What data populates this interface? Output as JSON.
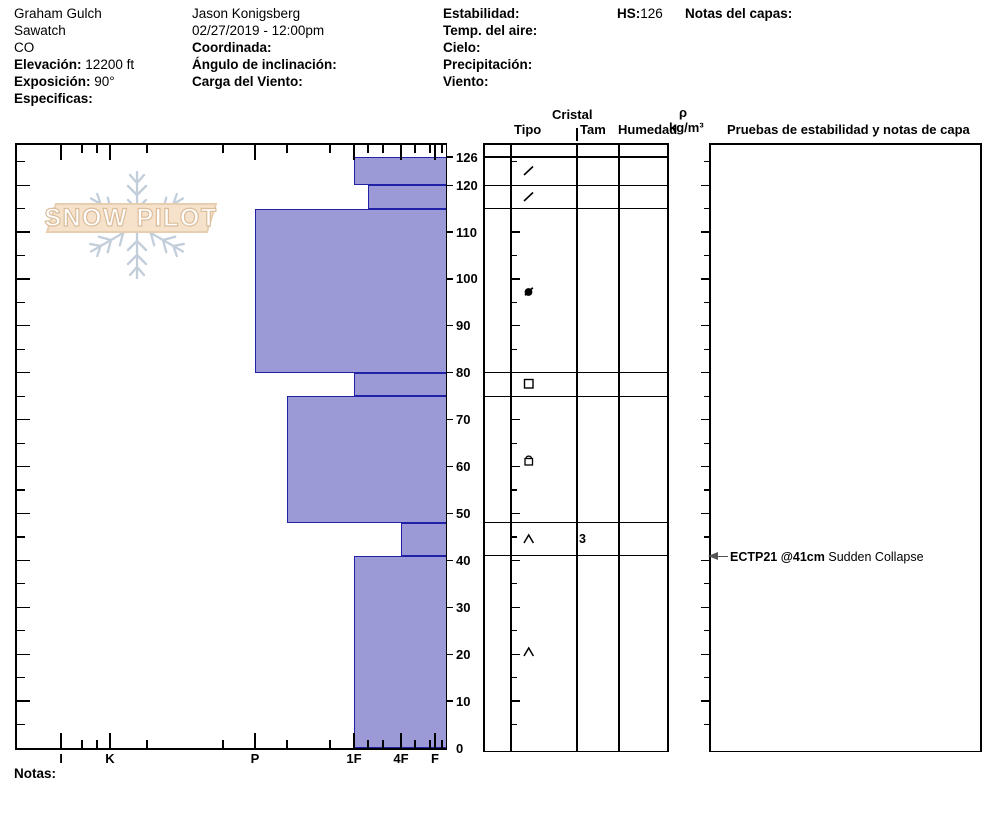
{
  "header": {
    "site": {
      "name": "Graham Gulch",
      "range": "Sawatch",
      "state": "CO",
      "elevation_label": "Elevación:",
      "elevation_value": "12200 ft",
      "aspect_label": "Exposición:",
      "aspect_value": "90°",
      "specifics_label": "Especificas:"
    },
    "observer": {
      "name": "Jason Konigsberg",
      "datetime": "02/27/2019 - 12:00pm",
      "coordinate_label": "Coordinada:",
      "slope_angle_label": "Ángulo de inclinación:",
      "wind_loading_label": "Carga del Viento:"
    },
    "weather": {
      "stability_label": "Estabilidad:",
      "air_temp_label": "Temp. del aire:",
      "sky_label": "Cielo:",
      "precipitation_label": "Precipitación:",
      "wind_label": "Viento:"
    },
    "hs_label": "HS:",
    "hs_value": "126",
    "layer_notes_label": "Notas del capas:"
  },
  "logo": {
    "text": "SNOW PILOT"
  },
  "chart_data": {
    "type": "bar",
    "orientation": "horizontal-hardness-profile",
    "depth_unit": "cm",
    "depth_max": 126,
    "snow_height": 126,
    "depth_labels": [
      126,
      120,
      110,
      100,
      90,
      80,
      70,
      60,
      50,
      40,
      30,
      20,
      10,
      0
    ],
    "hardness_categories": [
      {
        "label": "I",
        "x": 61
      },
      {
        "label": "K",
        "x": 110
      },
      {
        "label": "P",
        "x": 255
      },
      {
        "label": "1F",
        "x": 354
      },
      {
        "label": "4F",
        "x": 401
      },
      {
        "label": "F",
        "x": 435
      }
    ],
    "hardness_minor_ticks_x": [
      82,
      97,
      147,
      223,
      287,
      330,
      368,
      383,
      415,
      430,
      442
    ],
    "bar_fill": "#9b9ad7",
    "bar_border": "#2121a8",
    "layers": [
      {
        "top": 126,
        "bottom": 120,
        "hardness": "1F",
        "hardness_x": 354,
        "grain_type": "DF",
        "symbol": "slash",
        "size": "",
        "moisture": ""
      },
      {
        "top": 120,
        "bottom": 115,
        "hardness": "1F-",
        "hardness_x": 368,
        "grain_type": "DF",
        "symbol": "slash",
        "size": "",
        "moisture": ""
      },
      {
        "top": 115,
        "bottom": 80,
        "hardness": "P",
        "hardness_x": 255,
        "grain_type": "RGxf",
        "symbol": "dot-slash",
        "size": "",
        "moisture": ""
      },
      {
        "top": 80,
        "bottom": 75,
        "hardness": "1F",
        "hardness_x": 354,
        "grain_type": "FC",
        "symbol": "square",
        "size": "",
        "moisture": ""
      },
      {
        "top": 75,
        "bottom": 48,
        "hardness": "P-",
        "hardness_x": 287,
        "grain_type": "FCxr",
        "symbol": "square-dome",
        "size": "",
        "moisture": ""
      },
      {
        "top": 48,
        "bottom": 41,
        "hardness": "4F",
        "hardness_x": 401,
        "grain_type": "DH",
        "symbol": "caret",
        "size": "3",
        "moisture": ""
      },
      {
        "top": 41,
        "bottom": 0,
        "hardness": "1F",
        "hardness_x": 354,
        "grain_type": "DH",
        "symbol": "caret",
        "size": "",
        "moisture": ""
      }
    ],
    "stability_test": {
      "depth": 41,
      "label_bold": "ECTP21 @41cm",
      "label_normal": "Sudden Collapse"
    }
  },
  "profile_table": {
    "crystal_header": "Cristal",
    "tipo_header": "Tipo",
    "tam_header": "Tam",
    "humedad_header": "Humedad",
    "density_symbol": "ρ",
    "density_unit": "kg/m³",
    "tests_header": "Pruebas de estabilidad y notas de capa"
  },
  "footer": {
    "notes_label": "Notas:"
  }
}
